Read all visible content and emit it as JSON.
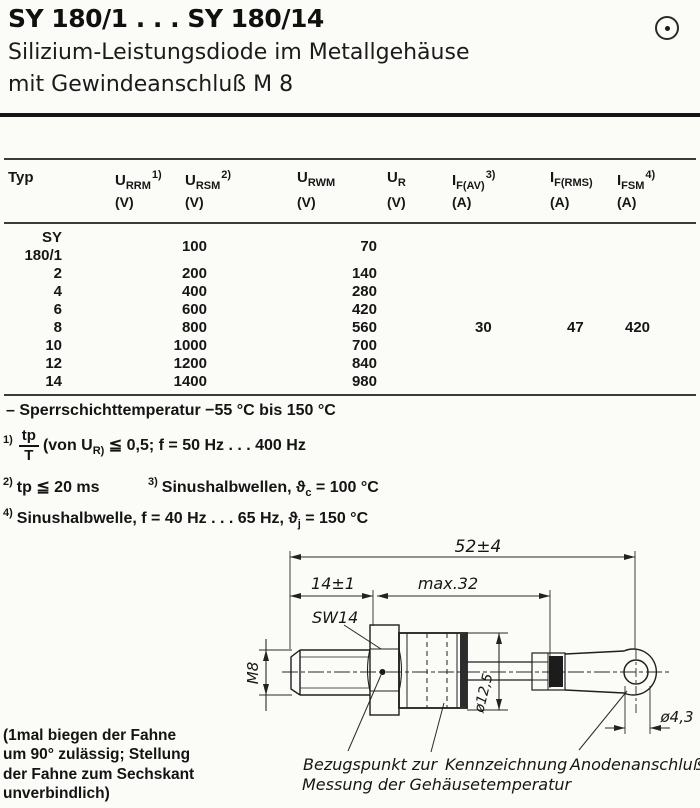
{
  "header": {
    "title": "SY 180/1 . . . SY 180/14",
    "subtitle_line1": "Silizium-Leistungsdiode im Metallgehäuse",
    "subtitle_line2": "mit Gewindeanschluß M 8"
  },
  "table": {
    "columns": [
      {
        "label": "Typ",
        "sym": "",
        "sub": "",
        "sup": "",
        "unit": ""
      },
      {
        "label": "URRM",
        "sym": "U",
        "sub": "RRM",
        "sup": "1)",
        "unit": "(V)"
      },
      {
        "label": "URSM",
        "sym": "U",
        "sub": "RSM",
        "sup": "2)",
        "unit": "(V)"
      },
      {
        "label": "URWM",
        "sym": "U",
        "sub": "RWM",
        "sup": "",
        "unit": "(V)"
      },
      {
        "label": "UR",
        "sym": "U",
        "sub": "R",
        "sup": "",
        "unit": "(V)"
      },
      {
        "label": "IF(AV)",
        "sym": "I",
        "sub": "F(AV)",
        "sup": "3)",
        "unit": "(A)"
      },
      {
        "label": "IF(RMS)",
        "sym": "I",
        "sub": "F(RMS)",
        "sup": "",
        "unit": "(A)"
      },
      {
        "label": "IFSM",
        "sym": "I",
        "sub": "FSM",
        "sup": "4)",
        "unit": "(A)"
      }
    ],
    "rows": [
      {
        "typ": "SY 180/1",
        "voltage": "100",
        "urwm": "70",
        "iav": "",
        "irms": "",
        "ifsm": ""
      },
      {
        "typ": "2",
        "voltage": "200",
        "urwm": "140",
        "iav": "",
        "irms": "",
        "ifsm": ""
      },
      {
        "typ": "4",
        "voltage": "400",
        "urwm": "280",
        "iav": "",
        "irms": "",
        "ifsm": ""
      },
      {
        "typ": "6",
        "voltage": "600",
        "urwm": "420",
        "iav": "",
        "irms": "",
        "ifsm": ""
      },
      {
        "typ": "8",
        "voltage": "800",
        "urwm": "560",
        "iav": "30",
        "irms": "47",
        "ifsm": "420"
      },
      {
        "typ": "10",
        "voltage": "1000",
        "urwm": "700",
        "iav": "",
        "irms": "",
        "ifsm": ""
      },
      {
        "typ": "12",
        "voltage": "1200",
        "urwm": "840",
        "iav": "",
        "irms": "",
        "ifsm": ""
      },
      {
        "typ": "14",
        "voltage": "1400",
        "urwm": "980",
        "iav": "",
        "irms": "",
        "ifsm": ""
      }
    ]
  },
  "notes": {
    "junction_temp": "– Sperrschichttemperatur −55 °C bis 150 °C",
    "fn1": {
      "marker": "1)",
      "num": "tp",
      "den": "T",
      "mid": "(von U",
      "usub": "R)",
      "tail": " ≦ 0,5;  f = 50 Hz . . . 400 Hz"
    },
    "fn2": {
      "marker": "2)",
      "text": "tp ≦ 20 ms"
    },
    "fn3": {
      "marker": "3)",
      "pre": "Sinushalbwellen,  ",
      "theta": "ϑ",
      "tsub": "c",
      "tail": " = 100 °C"
    },
    "fn4": {
      "marker": "4)",
      "pre": "Sinushalbwelle,  f = 40 Hz . . . 65 Hz,  ",
      "theta": "ϑ",
      "tsub": "j",
      "tail": " = 150 °C"
    }
  },
  "flag_note": {
    "line1": "(1mal biegen der Fahne",
    "line2": "um 90° zulässig; Stellung",
    "line3": "der Fahne zum Sechskant",
    "line4": "unverbindlich)"
  },
  "drawing": {
    "dim_total": "52±4",
    "dim_thread": "14±1",
    "dim_case": "max.32",
    "wrench_size": "SW14",
    "thread": "M8",
    "dia_case": "ø12,5",
    "dia_hole": "ø4,3",
    "cap_ref_line1": "Bezugspunkt zur",
    "cap_ref_line2": "Messung der Gehäusetemperatur",
    "cap_marking": "Kennzeichnung",
    "cap_anode": "Anodenanschluß"
  }
}
